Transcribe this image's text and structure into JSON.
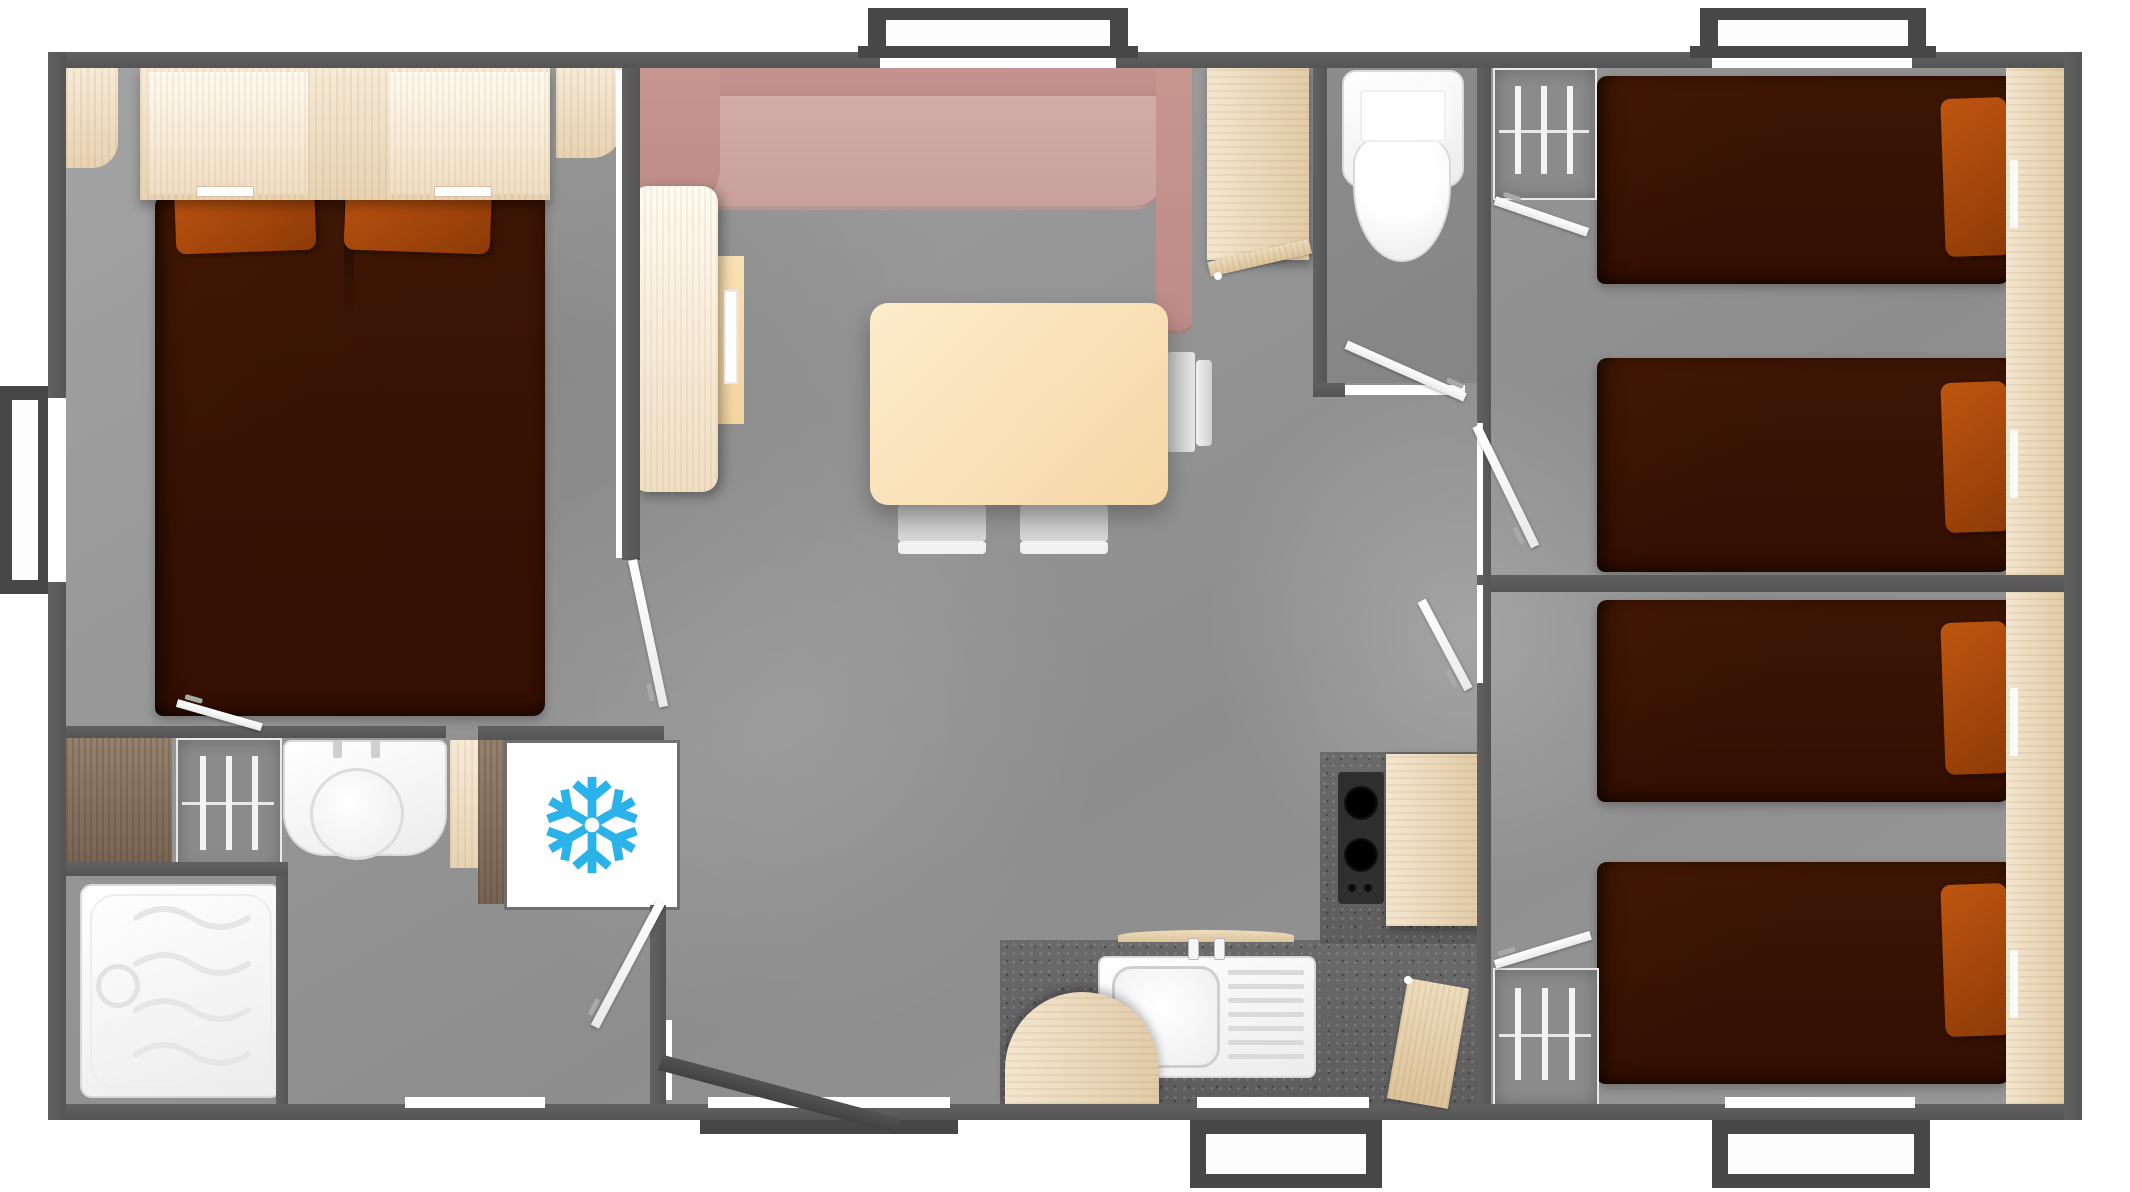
{
  "app": {
    "type": "floor-plan",
    "name": "Mobile home floor plan - top-down 3D render",
    "canvas": {
      "width": 2130,
      "height": 1192
    }
  },
  "palette": {
    "wall": "#5c5c5c",
    "floor": "#979797",
    "bed_cover_brown": "#3a1504",
    "pillow_orange": "#b04a0e",
    "sofa_back_pink": "#c18f8c",
    "sofa_seat_pink": "#cfa8a3",
    "table_cream": "#fbe3bd",
    "wood_light": "#f2e2ca",
    "wood_dark": "#8a7461",
    "kitchen_counter": "#646464",
    "fixture_white": "#ffffff",
    "snowflake_blue": "#2bb3e9",
    "exterior_door_grey": "#4a4a4a"
  },
  "icons": [
    {
      "name": "snowflake-icon",
      "meaning": "refrigerator-freezer appliance marker",
      "color": "#2bb3e9"
    }
  ],
  "rooms": [
    {
      "id": "master-bedroom",
      "furniture": [
        "double-bed",
        "headboard-shelf",
        "pillow",
        "pillow",
        "corner-shelf",
        "corner-shelf",
        "vanity-counter",
        "wardrobe-rail",
        "washbasin",
        "shelf",
        "fridge-freezer"
      ]
    },
    {
      "id": "shower-room",
      "furniture": [
        "shower-tray"
      ]
    },
    {
      "id": "living-dining",
      "furniture": [
        "corner-sofa",
        "tall-cabinet",
        "side-cabinet",
        "dining-table",
        "chair",
        "chair",
        "chair"
      ]
    },
    {
      "id": "wc",
      "furniture": [
        "toilet"
      ]
    },
    {
      "id": "kitchen",
      "furniture": [
        "sink-drainer",
        "gas-hob",
        "counter",
        "half-round-table",
        "cabinet-door"
      ]
    },
    {
      "id": "hallway",
      "furniture": []
    },
    {
      "id": "twin-bedroom-top",
      "furniture": [
        "single-bed",
        "single-bed",
        "pillow",
        "pillow",
        "bedside-shelf",
        "wardrobe-rail"
      ]
    },
    {
      "id": "twin-bedroom-bottom",
      "furniture": [
        "single-bed",
        "single-bed",
        "pillow",
        "pillow",
        "bedside-shelf",
        "wardrobe-rail"
      ]
    }
  ],
  "openings": {
    "windows_top": 2,
    "window_left": 1,
    "windows_bottom": 2,
    "entry_doors_bottom": 2,
    "interior_door_leaves": 9,
    "porch_steps": 2
  }
}
